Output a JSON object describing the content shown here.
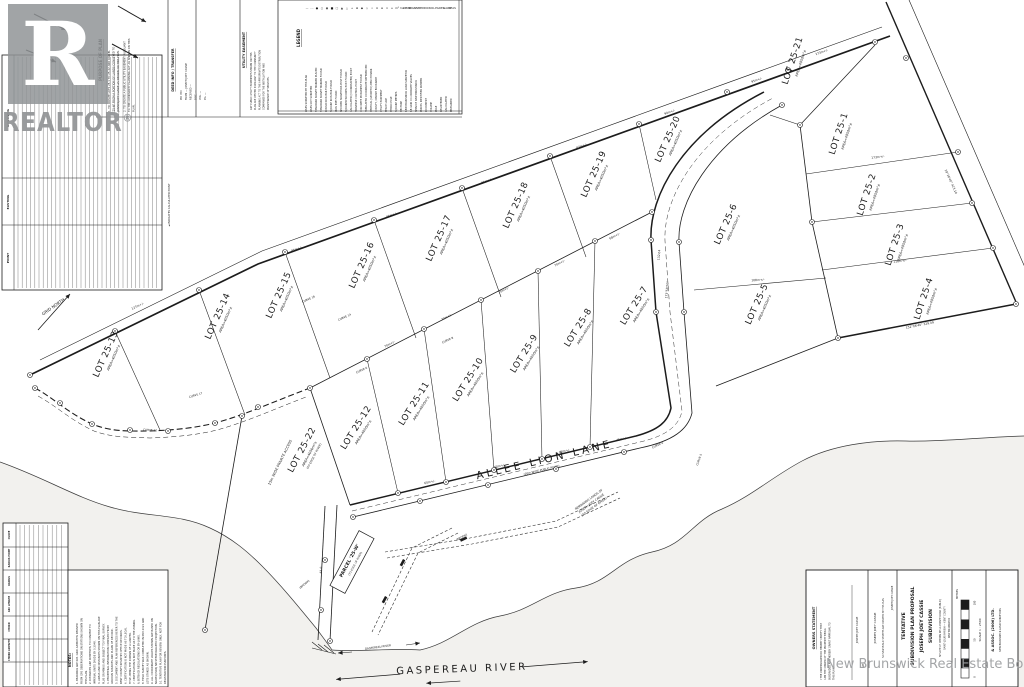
{
  "watermarks": {
    "realtor_letter": "R",
    "realtor_word": "REALTOR",
    "registered": "®",
    "board": "New Brunswick Real Estate Board"
  },
  "header_sections": {
    "purpose": {
      "title": "PURPOSE OF PLAN",
      "items": [
        "1. TO CREATE LOTS 25-1 TO 25-22 AND PARCEL '25-W' FROM A PORTION OF LANDS CONVEYED TO JOSEPH JOEY CASSIE AS SHOWN ON THIS PLAN.",
        "2. TO CREATE A PUBLIC UTILITY EASEMENT PURSUANT TO THE COMMUNITY PLANNING ACT AS SHOWN ON THIS PLAN."
      ]
    },
    "deed": {
      "title": "DEED INFO / TRANSFER",
      "items": [
        "PID 450",
        "FROM — JOSEPH JOEY CASSIE",
        "RECEIVED —",
        "DOC. —",
        "VOL. —",
        "PG. —"
      ]
    },
    "utility": {
      "title": "UTILITY EASEMENT",
      "text": "ANY PUBLIC UTILITY EASEMENTS SHOWN ON THIS PLAN ARE VESTED PURSUANT TO THE COMMUNITY PLANNING ACT TO THE APPROPRIATE DISTRIBUTION COMPANIES FOR THE INSTALLATION AND MAINTENANCE OF SERVICES."
    },
    "legend": {
      "title": "LEGEND",
      "entries": [
        {
          "sym": "—",
          "label": "LINES SURVEYED BY THIS PLAN"
        },
        {
          "sym": "- -",
          "label": "LINES NOT SURVEYED"
        },
        {
          "sym": "●",
          "label": "STANDARD SURVEY MARKER PLACED"
        },
        {
          "sym": "○",
          "label": "STANDARD SURVEY MARKER FOUND"
        },
        {
          "sym": "◉",
          "label": "ROUND IRON BAR FOUND"
        },
        {
          "sym": "■",
          "label": "SQUARE IRON BAR FOUND"
        },
        {
          "sym": "□",
          "label": "IRON PIPE FOUND"
        },
        {
          "sym": "▲",
          "label": "WOODEN SURVEYORS POST FOUND"
        },
        {
          "sym": "△",
          "label": "SQUARED WOODEN POST FOUND"
        },
        {
          "sym": "+",
          "label": "CALCULATED (COORDINATED) POINT"
        },
        {
          "sym": "⊕",
          "label": "TRAVERSE CONTROL POINT"
        },
        {
          "sym": "◆",
          "label": "CONCRETE MONUMENT FOUND"
        },
        {
          "sym": "◇",
          "label": "TABULATED COORDINATE REFERENCED"
        },
        {
          "sym": "⌖",
          "label": "VERTICAL (GEODETIC) BENCH MARK"
        },
        {
          "sym": "⊙",
          "label": "COUNTY / PARISH BOUNDARY"
        },
        {
          "sym": "≡",
          "label": "UTILITY EASEMENT"
        },
        {
          "sym": "×",
          "label": "FENCE LINE"
        },
        {
          "sym": "⌂",
          "label": "HYDRO POLE"
        },
        {
          "sym": "m²",
          "label": "SQUARE METRES"
        },
        {
          "sym": "ha",
          "label": "HECTARE"
        },
        {
          "sym": "NBLS",
          "label": "NEW BRUNSWICK LAND SURVEYOR"
        },
        {
          "sym": "NBGC",
          "label": "NB GRID CO-ORDINATE VALUES"
        },
        {
          "sym": "SNB",
          "label": "SERVICE NEW BRUNSWICK"
        },
        {
          "sym": "PID",
          "label": "PARCEL IDENTIFIER NUMBER"
        },
        {
          "sym": "DOC",
          "label": "DOCUMENT"
        },
        {
          "sym": "VOL",
          "label": "VOLUME"
        },
        {
          "sym": "PG",
          "label": "PAGE"
        },
        {
          "sym": "REG",
          "label": "REGISTERED"
        },
        {
          "sym": "CALC",
          "label": "CALCULATED"
        },
        {
          "sym": "MEAS",
          "label": "MEASURED"
        }
      ]
    }
  },
  "tables": {
    "point_table": {
      "headers": [
        "NORTHING",
        "EASTING",
        "POINT"
      ],
      "note": "◄ INDICATES CALCULATED POINT"
    },
    "curve_table": {
      "headers": [
        "CURVE",
        "RADIUS POINT",
        "RADIUS",
        "ARC LENGTH",
        "CHORD",
        "CHORD AZIMUTH"
      ]
    },
    "notes": {
      "title": "NOTES:",
      "items": [
        "1. BEARINGS ARE N.B. GRID AZIMUTHS DERIVED FROM GPS OBSERVATIONS ON STATIONS SHOWN ON THIS PLAN.",
        "2. DISTANCES ARE IN METRES; TO CONVERT TO IMPERIAL UNITS DIVIDE BY 0.3048.",
        "3. AREAS AND DISTANCES SHOWN ON THIS PLAN ARE PLUS OR MINUS AND SUBJECT TO FINAL SURVEY.",
        "4. PERIPHERAL INFORMATION COMPILED FROM VARIOUS SOURCES AND PLANS OF RECORD.",
        "5. DOCUMENT AND PLAN REFERENCES REFER TO THE KENT COUNTY REGISTRY OFFICE RECORDS.",
        "6. CERTIFICATION IS NOT MADE AS TO LEGAL TITLE, BEING THE DOMAIN OF A LAWYER.",
        "7. CERTIFICATION IS NOT MADE AS TO THE ZONING & SETBACK REGULATIONS OR BY-LAWS.",
        "8. FIELD SURVEY WAS COMPLETED IN MAY 2021 AND LOTS STAKED AS SHOWN.",
        "9. ALL COORDINATE VALUES SHOWN ARE BASED ON NAD83(CSRS) NB STEREOGRAPHIC PROJECTION.",
        "10. TENTATIVE PLAN FOR REVIEW ONLY, NOT FOR REGISTRATION PURPOSES."
      ]
    }
  },
  "map": {
    "north_label": "GRID NORTH",
    "roads": {
      "lane": {
        "name": "ALLEE LION LANE",
        "sub": "(20m WIDE PUBLIC ROAD)"
      },
      "access": {
        "name": "15m WIDE PRIVATE ACCESS"
      }
    },
    "river": {
      "name": "GASPEREAU RIVER",
      "small": "GASPEREAU RIVER"
    },
    "lots": [
      {
        "label": "LOT 25-13",
        "area": "AREA=4050m²±",
        "x": 110,
        "y": 356,
        "r": -66
      },
      {
        "label": "LOT 25-14",
        "area": "AREA=4050m²±",
        "x": 222,
        "y": 318,
        "r": -66
      },
      {
        "label": "LOT 25-15",
        "area": "AREA=4050m²±",
        "x": 283,
        "y": 297,
        "r": -66
      },
      {
        "label": "LOT 25-16",
        "area": "AREA=4050m²±",
        "x": 366,
        "y": 267,
        "r": -66
      },
      {
        "label": "LOT 25-17",
        "area": "AREA=4050m²±",
        "x": 443,
        "y": 240,
        "r": -66
      },
      {
        "label": "LOT 25-18",
        "area": "AREA=4050m²±",
        "x": 520,
        "y": 207,
        "r": -66
      },
      {
        "label": "LOT 25-19",
        "area": "AREA=4050m²±",
        "x": 598,
        "y": 176,
        "r": -66
      },
      {
        "label": "LOT 25-20",
        "area": "AREA=4050m²±",
        "x": 672,
        "y": 141,
        "r": -66
      },
      {
        "label": "LOT 25-21",
        "area": "AREA=4050m²±",
        "x": 797,
        "y": 62,
        "r": -72
      },
      {
        "label": "LOT 25-1",
        "area": "AREA=4050m²±",
        "x": 843,
        "y": 135,
        "r": -72
      },
      {
        "label": "LOT 25-2",
        "area": "AREA=4050m²±",
        "x": 871,
        "y": 196,
        "r": -72
      },
      {
        "label": "LOT 25-3",
        "area": "AREA=4050m²±",
        "x": 899,
        "y": 246,
        "r": -72
      },
      {
        "label": "LOT 25-4",
        "area": "AREA=4050m²±",
        "x": 928,
        "y": 300,
        "r": -72
      },
      {
        "label": "LOT 25-5",
        "area": "AREA=4050m²±",
        "x": 761,
        "y": 306,
        "r": -66
      },
      {
        "label": "LOT 25-6",
        "area": "AREA=4050m²±",
        "x": 730,
        "y": 226,
        "r": -66
      },
      {
        "label": "LOT 25-7",
        "area": "AREA=4050m²±",
        "x": 638,
        "y": 308,
        "r": -58
      },
      {
        "label": "LOT 25-8",
        "area": "AREA=4050m²±",
        "x": 582,
        "y": 330,
        "r": -58
      },
      {
        "label": "LOT 25-9",
        "area": "AREA=4050m²±",
        "x": 528,
        "y": 356,
        "r": -58
      },
      {
        "label": "LOT 25-10",
        "area": "AREA=4050m²±",
        "x": 472,
        "y": 382,
        "r": -58
      },
      {
        "label": "LOT 25-11",
        "area": "AREA=4050m²±",
        "x": 418,
        "y": 406,
        "r": -58
      },
      {
        "label": "LOT 25-12",
        "area": "AREA=4050m²±",
        "x": 360,
        "y": 430,
        "r": -58
      },
      {
        "label": "LOT 25-22",
        "area": "AREA=4050m²±",
        "note": "(TO EDGE OF RIVER)",
        "x": 306,
        "y": 452,
        "r": -62
      }
    ],
    "parcel": {
      "label": "PARCEL '25-W'",
      "note": "(TO EDGE OF RIVER)",
      "x": 352,
      "y": 562,
      "r": -62
    },
    "remnant_lines": [
      "REMAINING LANDS OF",
      "JOSEPH JOEY CASSIE",
      "(TO EDGE OF RIVER)"
    ],
    "stream_labels": [
      {
        "t": "(BROOK)",
        "x": 305,
        "y": 585,
        "r": -40
      },
      {
        "t": "(BROOK)",
        "x": 462,
        "y": 538,
        "r": -28
      }
    ],
    "curve_labels": [
      {
        "t": "CURVE 16",
        "x": 309,
        "y": 300,
        "r": -25
      },
      {
        "t": "CURVE 14",
        "x": 345,
        "y": 318,
        "r": -25
      },
      {
        "t": "CURVE 12",
        "x": 150,
        "y": 431,
        "r": 3
      },
      {
        "t": "CURVE 17",
        "x": 196,
        "y": 396,
        "r": -18
      },
      {
        "t": "CURVE 8",
        "x": 448,
        "y": 341,
        "r": -25
      },
      {
        "t": "CURVE 6",
        "x": 362,
        "y": 371,
        "r": -25
      },
      {
        "t": "CURVE 4",
        "x": 658,
        "y": 446,
        "r": -25
      },
      {
        "t": "CURVE 5",
        "x": 700,
        "y": 460,
        "r": -70
      }
    ],
    "dims": [
      {
        "t": "127m+/-",
        "x": 138,
        "y": 307,
        "r": -26
      },
      {
        "t": "95m+/-",
        "x": 297,
        "y": 250,
        "r": -20
      },
      {
        "t": "85m+/-",
        "x": 392,
        "y": 216,
        "r": -20
      },
      {
        "t": "85m+/-",
        "x": 487,
        "y": 182,
        "r": -20
      },
      {
        "t": "87m+/-",
        "x": 582,
        "y": 147,
        "r": -20
      },
      {
        "t": "90m+/-",
        "x": 670,
        "y": 113,
        "r": -20
      },
      {
        "t": "95m+/-",
        "x": 757,
        "y": 81,
        "r": -20
      },
      {
        "t": "173m+/-",
        "x": 822,
        "y": 53,
        "r": -20
      },
      {
        "t": "70m+/-",
        "x": 390,
        "y": 345,
        "r": -27
      },
      {
        "t": "70m+/-",
        "x": 447,
        "y": 318,
        "r": -27
      },
      {
        "t": "70m+/-",
        "x": 504,
        "y": 291,
        "r": -27
      },
      {
        "t": "70m+/-",
        "x": 560,
        "y": 264,
        "r": -27
      },
      {
        "t": "68m+/-",
        "x": 615,
        "y": 237,
        "r": -27
      },
      {
        "t": "60m+/-",
        "x": 430,
        "y": 483,
        "r": -13
      },
      {
        "t": "60m+/-",
        "x": 500,
        "y": 467,
        "r": -13
      },
      {
        "t": "60m+/-",
        "x": 565,
        "y": 452,
        "r": -13
      },
      {
        "t": "45m+/-",
        "x": 622,
        "y": 440,
        "r": -13
      },
      {
        "t": "173m+/-",
        "x": 878,
        "y": 158,
        "r": -7
      },
      {
        "t": "108m+/-",
        "x": 758,
        "y": 281,
        "r": -3
      },
      {
        "t": "118m+/-",
        "x": 900,
        "y": 262,
        "r": -7
      },
      {
        "t": "29°26'40\" 423.10",
        "x": 950,
        "y": 182,
        "r": 66
      },
      {
        "t": "152°06'40\" 329.09",
        "x": 920,
        "y": 326,
        "r": -11
      },
      {
        "t": "173°58'20\"",
        "x": 668,
        "y": 290,
        "r": -85
      },
      {
        "t": "132.04",
        "x": 660,
        "y": 255,
        "r": -85
      },
      {
        "t": "61.0",
        "x": 322,
        "y": 570,
        "r": -88
      }
    ]
  },
  "title_block": {
    "statement_title": "OWNERS STATEMENT",
    "statement_text": "I THE UNDERSIGNED DO HEREBY CERTIFY THAT I AM THE OWNER OF THE PROPERTY BEING SUBDIVIDED AND HEREBY GRANT APPROVAL TO THIS PLAN.",
    "owner": "JOSEPH JOEY CASSIE",
    "owner_note": "NO NEW PUBLIC STREETS ARE CREATED BY THIS PLAN",
    "date_label": "DATE",
    "plan_title": [
      "TENTATIVE",
      "SUBDIVISION PLAN PROPOSAL",
      "JOSEPH JOEY CASSIE",
      "SUBDIVISION"
    ],
    "location": [
      "SITUATE AT CHEMIN DE LA POINTE ROAD (PUBLIC)",
      "SAINT-LOUIS PARISH — KENT COUNTY",
      "NEW BRUNSWICK"
    ],
    "metres": "METRES",
    "scale_label": "SCALE 1 : 2500",
    "scale_ticks": [
      "100",
      "50",
      "0"
    ],
    "firm": "& ASSOC. (2006) LTD.",
    "firm_sub": "NEW BRUNSWICK LAND SURVEYORS"
  }
}
